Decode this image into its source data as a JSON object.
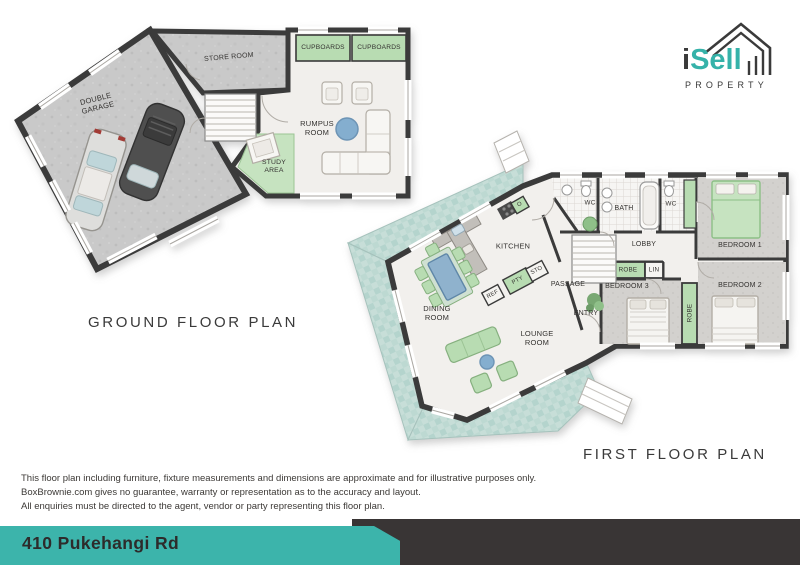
{
  "logo": {
    "brand_i": "i",
    "brand_sell": "Sell",
    "subtitle": "PROPERTY"
  },
  "ground_floor": {
    "title": "GROUND FLOOR PLAN",
    "labels": {
      "double_garage": "DOUBLE GARAGE",
      "store_room": "STORE ROOM",
      "cupboards_left": "CUPBOARDS",
      "cupboards_right": "CUPBOARDS",
      "rumpus_room": "RUMPUS ROOM",
      "study_area": "STUDY AREA"
    }
  },
  "first_floor": {
    "title": "FIRST FLOOR PLAN",
    "labels": {
      "kitchen": "KITCHEN",
      "dining_room": "DINING ROOM",
      "lounge_room": "LOUNGE ROOM",
      "passage": "PASSAGE",
      "entry": "ENTRY",
      "lobby": "LOBBY",
      "bath": "BATH",
      "wc_left": "WC",
      "wc_right": "WC",
      "bedroom_1": "BEDROOM 1",
      "bedroom_2": "BEDROOM 2",
      "bedroom_3": "BEDROOM 3",
      "robe_lobby": "ROBE",
      "linen": "LIN",
      "robe_bedroom": "ROBE",
      "fridge": "REF",
      "pantry": "PTY",
      "store": "STO",
      "oven": "O"
    }
  },
  "disclaimer": {
    "line1": "This floor plan including furniture, fixture measurements and dimensions are approximate and for illustrative purposes only.",
    "line2": "BoxBrownie.com gives no guarantee, warranty or representation as to the accuracy and layout.",
    "line3": "All enquiries must be directed to the agent, vendor or party representing this floor plan."
  },
  "footer": {
    "address": "410 Pukehangi Rd"
  },
  "colors": {
    "teal": "#3cb4ab",
    "dark": "#393535",
    "deck": "#c7ded8",
    "green": "#b8dcb2",
    "logo_teal": "#35b2a9"
  }
}
